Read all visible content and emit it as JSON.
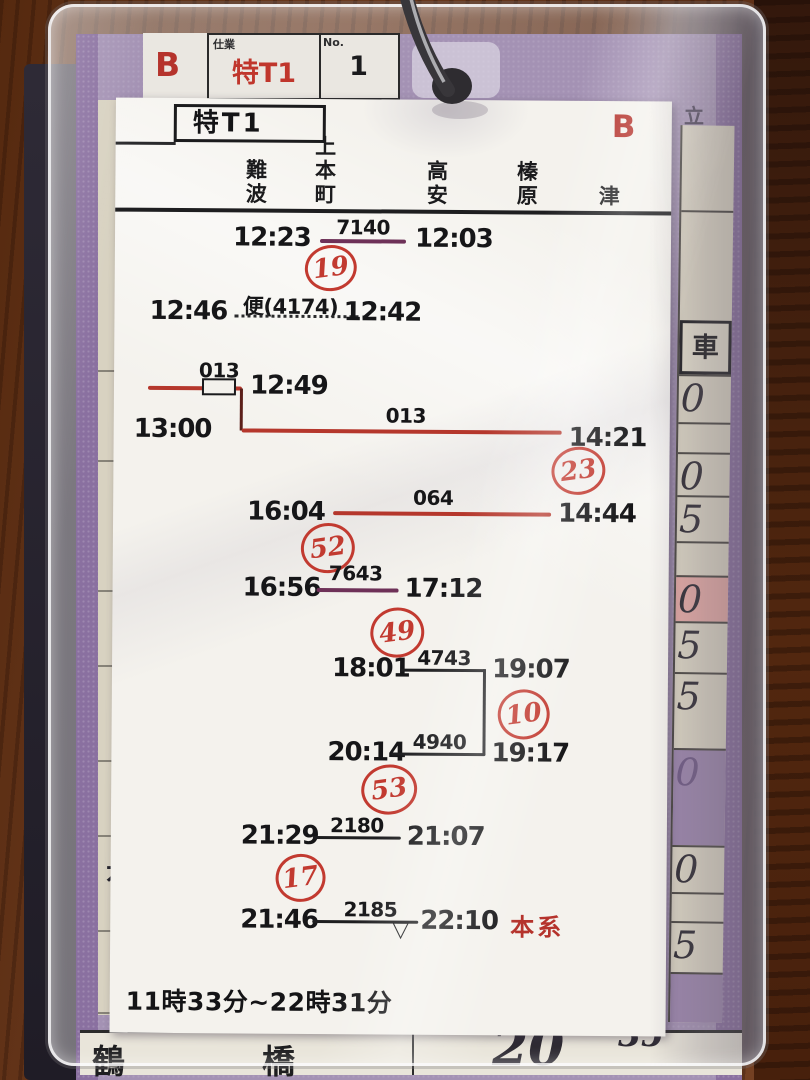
{
  "tag": {
    "b": "B",
    "duty_label": "仕業",
    "duty": "特T1",
    "no_label": "No.",
    "no": "1"
  },
  "card": {
    "duty": "特T1",
    "b": "B",
    "stations": [
      "難波",
      "上本町",
      "高安",
      "榛原",
      "津"
    ],
    "span": "11時33分~22時31分"
  },
  "rows": {
    "r1": {
      "dep": "12:23",
      "train": "7140",
      "arr": "12:03",
      "circle": "19"
    },
    "r2": {
      "dep": "12:46",
      "train": "便(4174)",
      "arr": "12:42"
    },
    "r3": {
      "train": "013",
      "arr": "12:49"
    },
    "r4": {
      "dep": "13:00",
      "train": "013",
      "arr": "14:21",
      "circle": "23"
    },
    "r5": {
      "dep": "16:04",
      "train": "064",
      "arr": "14:44",
      "circle": "52"
    },
    "r6": {
      "dep": "16:56",
      "train": "7643",
      "arr": "17:12",
      "circle": "49"
    },
    "r7": {
      "dep": "18:01",
      "train": "4743",
      "arr": "19:07",
      "circle": "10"
    },
    "r8": {
      "dep": "20:14",
      "train": "4940",
      "arr": "19:17",
      "circle": "53"
    },
    "r9": {
      "dep": "21:29",
      "train": "2180",
      "arr": "21:07",
      "circle": "17"
    },
    "r10": {
      "dep": "21:46",
      "train": "2185",
      "arr": "22:10",
      "note": "本系"
    }
  },
  "back_card": {
    "car_label": "車",
    "top_right": "立",
    "left_partial": "花",
    "right_cells": [
      "0",
      "0",
      "5",
      "0",
      "5",
      "5",
      "0",
      "0",
      "5"
    ],
    "bottom": {
      "left": "鶴",
      "mid": "橋",
      "big": "20",
      "small": "35"
    }
  },
  "colors": {
    "red_line": "#b5372c",
    "purple_line": "#6e3158",
    "hand_red": "#c23a30",
    "ink": "#161618"
  }
}
